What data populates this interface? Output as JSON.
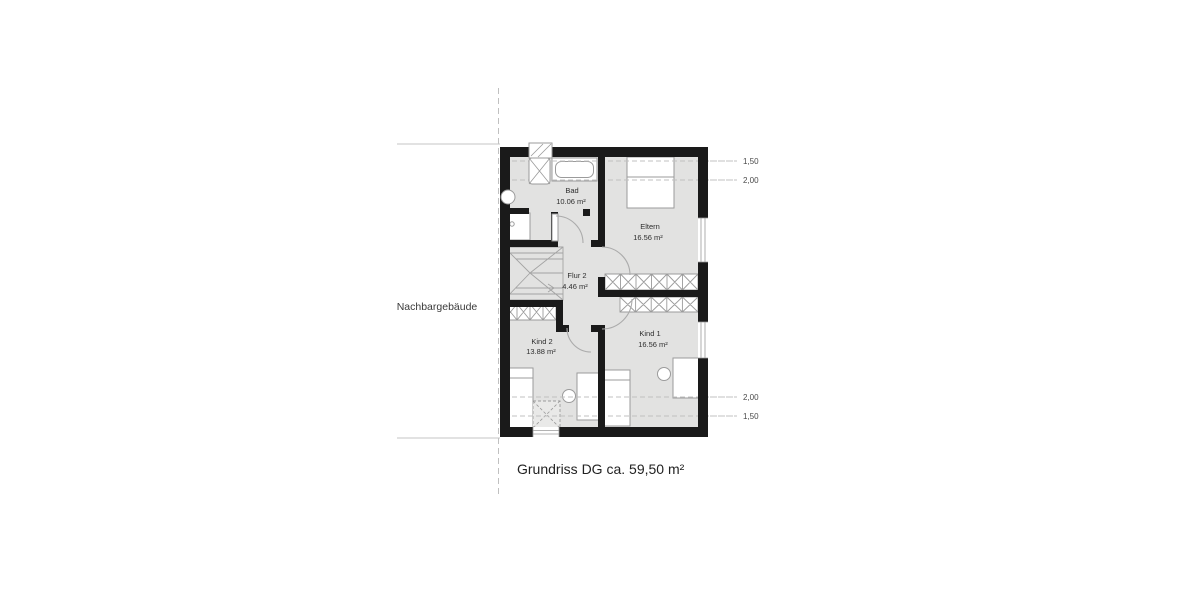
{
  "title": "Grundriss DG ca. 59,50 m²",
  "neighbor_label": "Nachbargebäude",
  "floor_code": "DG",
  "total_area": "59,50 m²",
  "rooms": {
    "bad": {
      "name": "Bad",
      "area": "10.06 m²"
    },
    "eltern": {
      "name": "Eltern",
      "area": "16.56 m²"
    },
    "flur": {
      "name": "Flur 2",
      "area": "4.46 m²"
    },
    "kind2": {
      "name": "Kind 2",
      "area": "13.88 m²"
    },
    "kind1": {
      "name": "Kind 1",
      "area": "16.56 m²"
    }
  },
  "height_markers": {
    "top_first": "1,50",
    "top_second": "2,00",
    "bottom_first": "2,00",
    "bottom_second": "1,50"
  },
  "colors": {
    "wall": "#1a1a1a",
    "floor": "#e2e2e1",
    "furn": "#9b9b9b",
    "dash": "#c0c0c0",
    "text": "#2e2e2e"
  }
}
